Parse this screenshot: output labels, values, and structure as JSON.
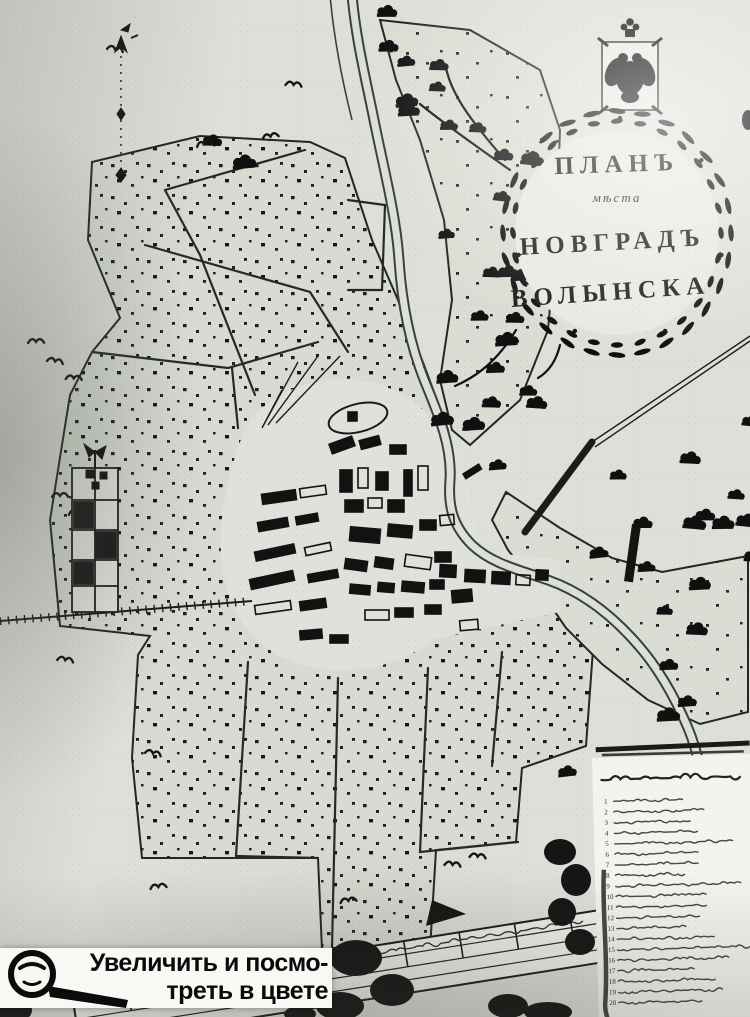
{
  "cartouche": {
    "line1": "Планъ",
    "line2": "мѣста",
    "line3": "Новградъ",
    "line4": "Волынска"
  },
  "overlay_button": {
    "line1": "Увеличить и посмо-",
    "line2": "треть в цвете",
    "icon": "magnifier-icon"
  },
  "legend_panel": {
    "row_count": 20,
    "row_numbers": [
      "1",
      "2",
      "3",
      "4",
      "5",
      "6",
      "7",
      "8",
      "9",
      "10",
      "11",
      "12",
      "13",
      "14",
      "15",
      "16",
      "17",
      "18",
      "19",
      "20"
    ]
  },
  "icons": {
    "emblem": "imperial-double-eagle",
    "compass": "north-arrow",
    "tree": "tree-icon",
    "bird": "bird-mark-icon"
  },
  "colors": {
    "paper": "#dde0d8",
    "paper_bright": "#f2f3ee",
    "ink": "#161616",
    "river_bank": "#39413a",
    "river_water": "#dde0d6",
    "overlay_bg": "#f8f8f4"
  }
}
